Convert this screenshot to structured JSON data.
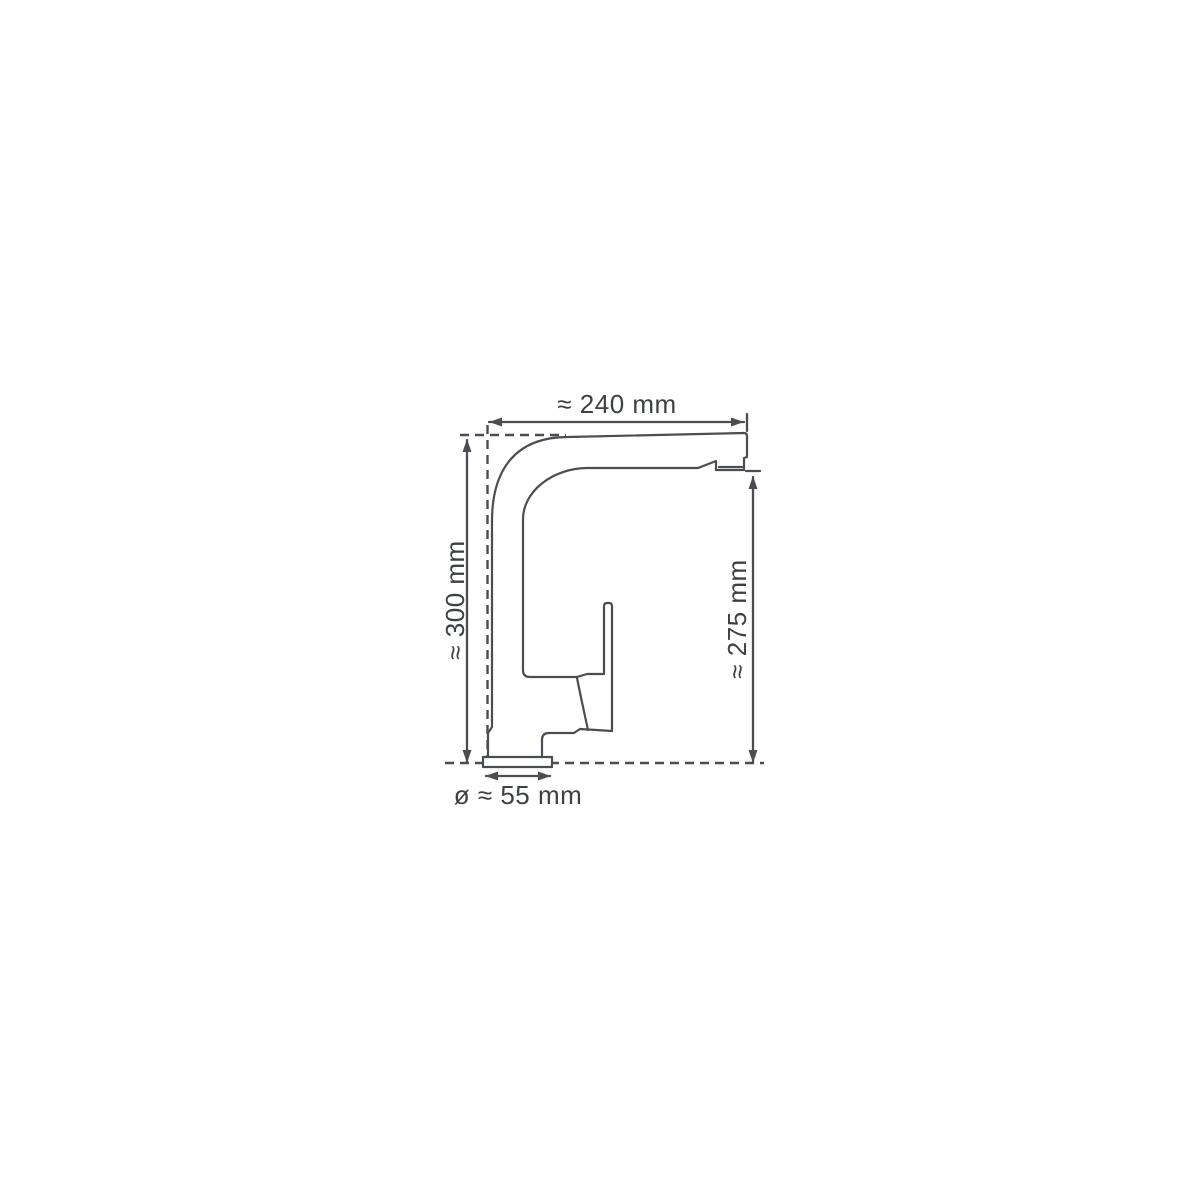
{
  "diagram": {
    "dimensions": {
      "top_width": "≈ 240 mm",
      "left_height": "≈ 300 mm",
      "right_height": "≈ 275 mm",
      "base_diameter": "ø ≈ 55 mm"
    },
    "colors": {
      "line": "#4a4e53",
      "text": "#3d4145",
      "background": "#ffffff"
    }
  }
}
